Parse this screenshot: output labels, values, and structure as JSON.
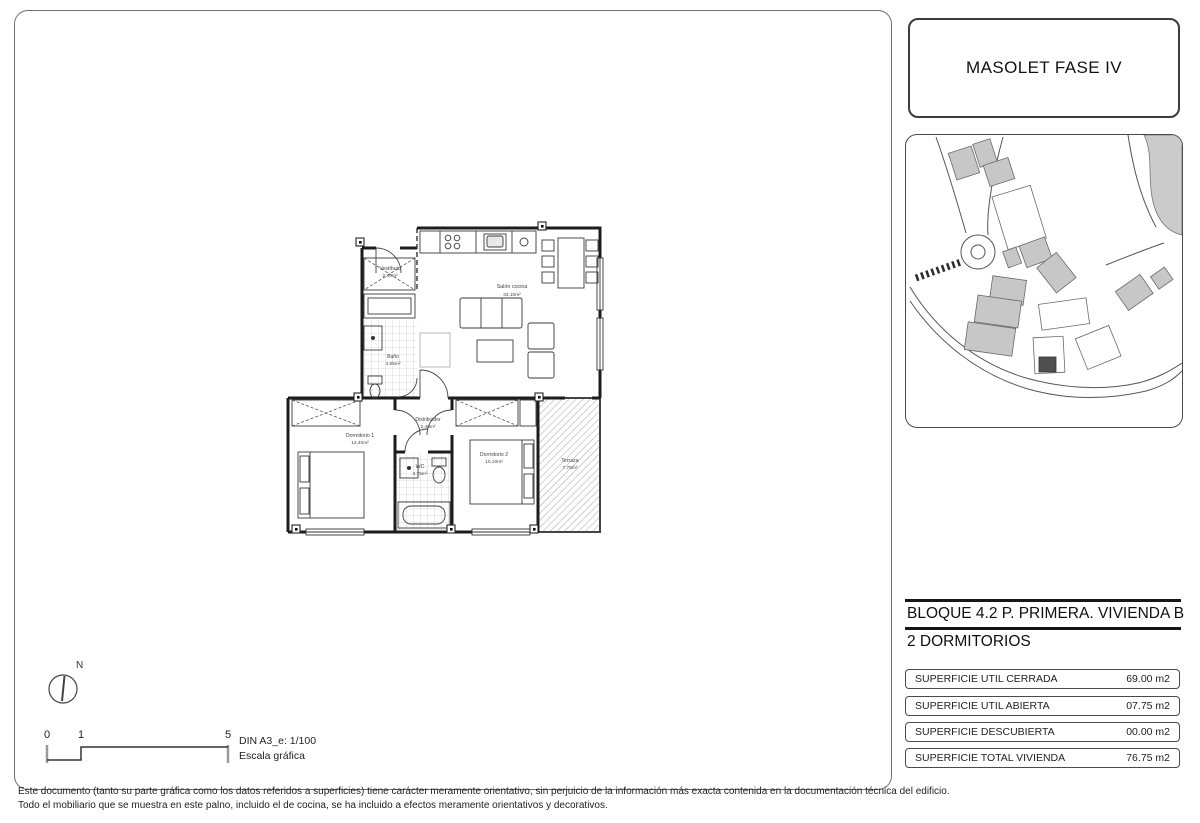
{
  "project": {
    "title": "MASOLET FASE IV"
  },
  "unit": {
    "line1": "BLOQUE 4.2 P. PRIMERA. VIVIENDA B",
    "line2": "2 DORMITORIOS"
  },
  "surfaces": {
    "rows": [
      {
        "label": "SUPERFICIE UTIL CERRADA",
        "value": "69.00 m2"
      },
      {
        "label": "SUPERFICIE UTIL ABIERTA",
        "value": "07.75 m2"
      },
      {
        "label": "SUPERFICIE DESCUBIERTA",
        "value": "00.00 m2"
      },
      {
        "label": "SUPERFICIE TOTAL VIVIENDA",
        "value": "76.75 m2"
      }
    ]
  },
  "floorplan": {
    "rooms": [
      {
        "name": "Vestíbulo",
        "area": "2,40m²"
      },
      {
        "name": "Salón cocina",
        "area": "33,10m²"
      },
      {
        "name": "Baño",
        "area": "4,65m²"
      },
      {
        "name": "Distribuidor",
        "area": "2,40m²"
      },
      {
        "name": "Dormitorio 1",
        "area": "12,40m²"
      },
      {
        "name": "WC",
        "area": "3,75m²"
      },
      {
        "name": "Dormitorio 2",
        "area": "10,10m²"
      },
      {
        "name": "Terraza",
        "area": "7,75m²"
      }
    ]
  },
  "scale": {
    "north": "N",
    "ticks": [
      "0",
      "1",
      "5"
    ],
    "din": "DIN A3_e: 1/100",
    "caption": "Escala gráfica"
  },
  "disclaimer": {
    "line1": "Este documento (tanto su parte gráfica como los datos referidos a superficies) tiene carácter meramente orientativo, sin perjuicio de la información más exacta contenida en la documentación  técnica del edificio.",
    "line2": "Todo el mobiliario que se muestra en este palno, incluido el de cocina, se ha incluido a efectos meramente orientativos y decorativos."
  },
  "colors": {
    "line": "#1c1c1c",
    "building_gray": "#c7c7c7",
    "highlight_building": "#4f4f4f"
  }
}
